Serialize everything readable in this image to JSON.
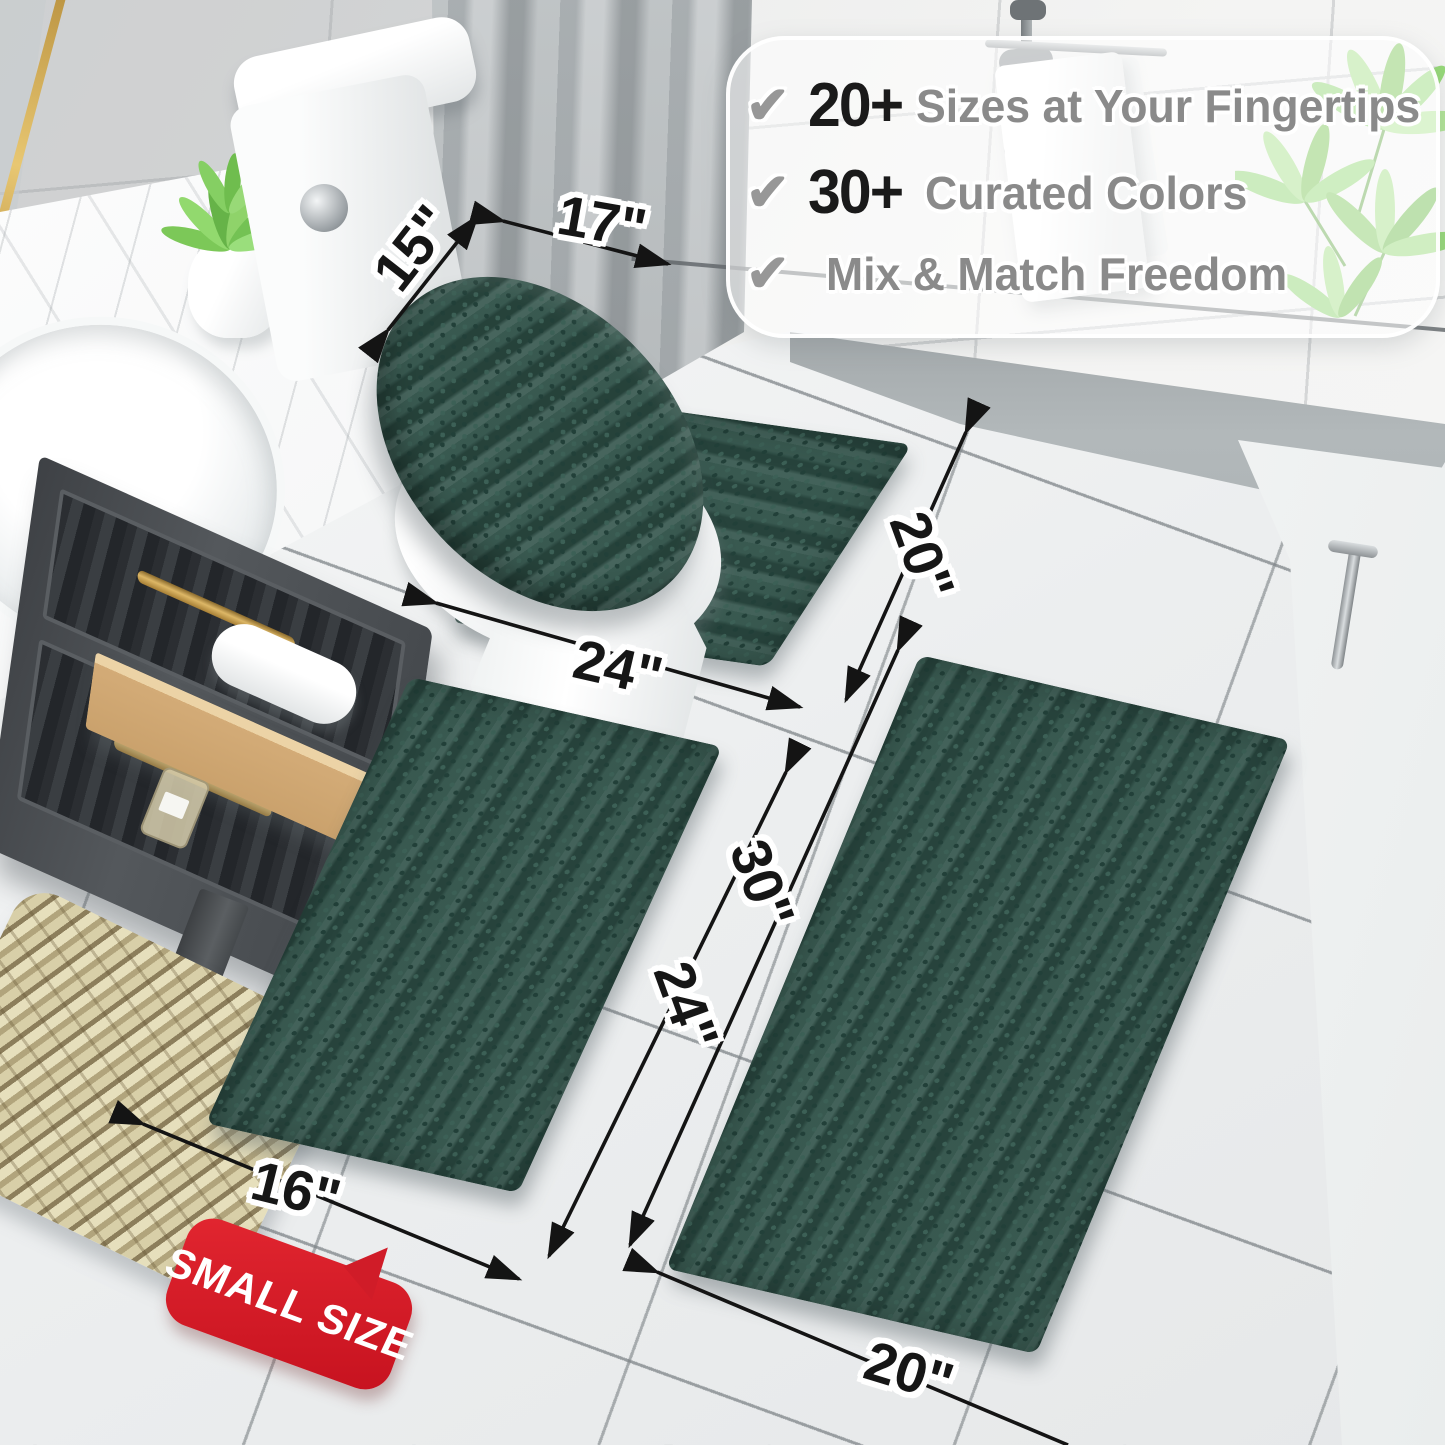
{
  "callout": {
    "items": [
      {
        "icon": "check",
        "prefix": "20+",
        "label": "Sizes at Your Fingertips"
      },
      {
        "icon": "check",
        "prefix": "30+",
        "label": "Curated Colors"
      },
      {
        "icon": "check",
        "prefix": "",
        "label": "Mix & Match Freedom"
      }
    ]
  },
  "dimensions": {
    "lid_cover": {
      "width": "17\"",
      "depth": "15\""
    },
    "contour_rug": {
      "width": "24\"",
      "depth": "20\""
    },
    "small_rug": {
      "length": "24\"",
      "width": "16\""
    },
    "large_rug": {
      "length": "30\"",
      "width": "20\""
    }
  },
  "badge": {
    "label": "SMALL SIZE"
  },
  "colors": {
    "rug_green": "#2e5047",
    "badge_red": "#d01c28",
    "dimension_text": "#161616",
    "feature_text_gray": "#8a8a8a",
    "feature_number_black": "#1a1a1a",
    "gold_hardware": "#d4ad5c",
    "plant_green": "#8fd472"
  }
}
